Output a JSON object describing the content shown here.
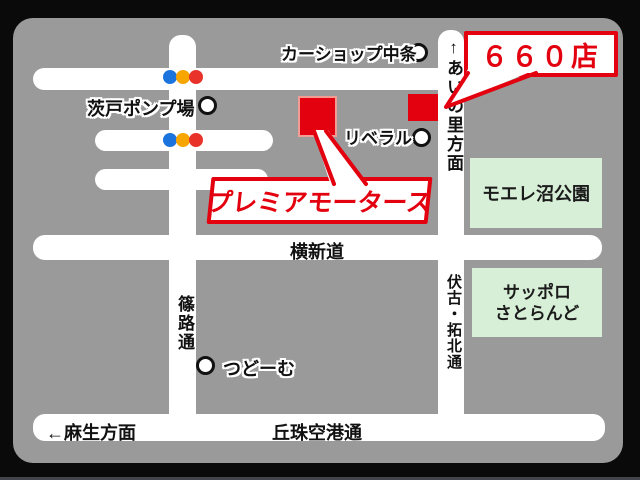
{
  "map": {
    "callouts": {
      "store": {
        "label": "６６０店"
      },
      "dealer": {
        "label": "プレミアモータース"
      }
    },
    "roads": {
      "yokoshindo": {
        "label": "横新道"
      },
      "okadama_airport": {
        "label": "丘珠空港通"
      },
      "asabu_direction": {
        "label": "←麻生方面"
      },
      "shinoro": {
        "label": "篠路通"
      },
      "ainosato_direction": {
        "label": "↑あいの里方面"
      },
      "fushiko_takuhoku": {
        "label": "伏古・拓北通"
      }
    },
    "landmarks": {
      "car_shop_nakajo": {
        "label": "カーショップ中条"
      },
      "barato_pump_station": {
        "label": "茨戸ポンプ場"
      },
      "liberal": {
        "label": "リベラル"
      },
      "tsudome": {
        "label": "つどーむ"
      },
      "moere_numa_park": {
        "label": "モエレ沼公園"
      },
      "sapporo_satoland": {
        "line1": "サッポロ",
        "line2": "さとらんど"
      }
    },
    "colors": {
      "accent_red": "#e3000f",
      "map_gray": "#9a9a9a",
      "road_white": "#ffffff",
      "park_green": "#d7eed7",
      "signal_blue": "#1b74dd",
      "signal_amber": "#f7a600",
      "signal_red": "#e8322a",
      "background_black": "#0a0a0a"
    }
  }
}
